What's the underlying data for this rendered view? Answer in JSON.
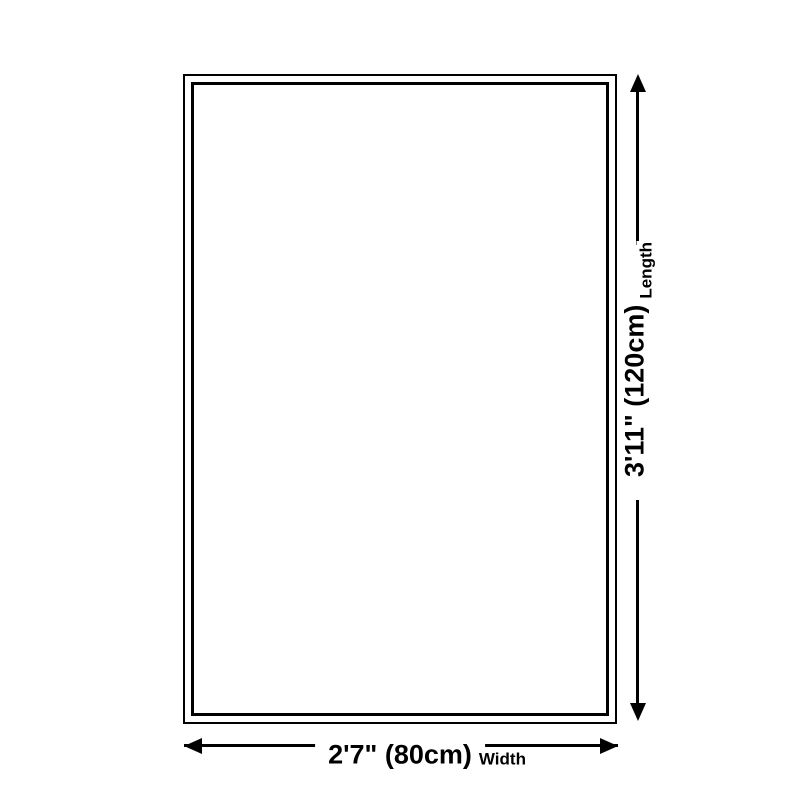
{
  "diagram": {
    "length": {
      "value": "3'11\" (120cm)",
      "label": "Length"
    },
    "width": {
      "value": "2'7\" (80cm)",
      "label": "Width"
    }
  },
  "colors": {
    "line": "#000000",
    "background": "#ffffff"
  }
}
